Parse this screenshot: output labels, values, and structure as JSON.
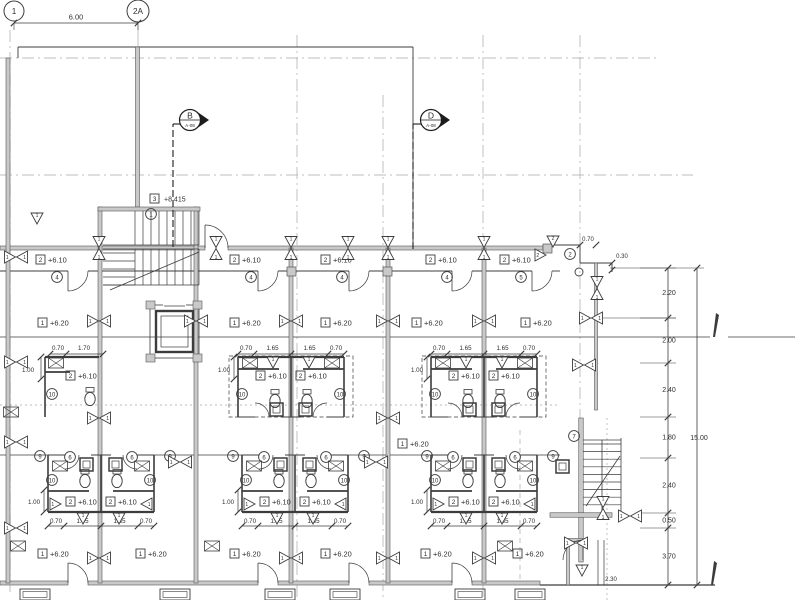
{
  "drawing": {
    "type": "architectural-floor-plan",
    "ink_color": "#3c3c3c",
    "grid_color": "#a9a9a9",
    "wall_fill": "#c9c9c9",
    "section_line_color": "#1c1c1c"
  },
  "grid_bubbles": {
    "g1": "1",
    "g2a": "2A"
  },
  "section_markers": {
    "b": {
      "label": "B",
      "sheet": "A-08"
    },
    "d": {
      "label": "D",
      "sheet": "A-08"
    }
  },
  "levels": {
    "corridor": "+6.10",
    "room": "+6.20",
    "stair": "+8.415"
  },
  "level_box_tags": {
    "corridor": "2",
    "room": "1",
    "stair": "3"
  },
  "keynotes": {
    "n1": "1",
    "n2": "2",
    "n4": "4",
    "n5": "5",
    "n6": "6",
    "n7": "7",
    "n9": "9",
    "n10": "10"
  },
  "door_window_tags": {
    "t1": "1",
    "t2": "2"
  },
  "dims": {
    "bay": "6.00",
    "d070": "0.70",
    "d170": "1.70",
    "d165": "1.65",
    "d100": "1.00",
    "d030": "0.30",
    "d220": "2.20",
    "d200": "2.00",
    "d240": "2.40",
    "d180": "1.80",
    "d050": "0.50",
    "d370": "3.70",
    "total": "15.00",
    "d230": "2.30"
  }
}
